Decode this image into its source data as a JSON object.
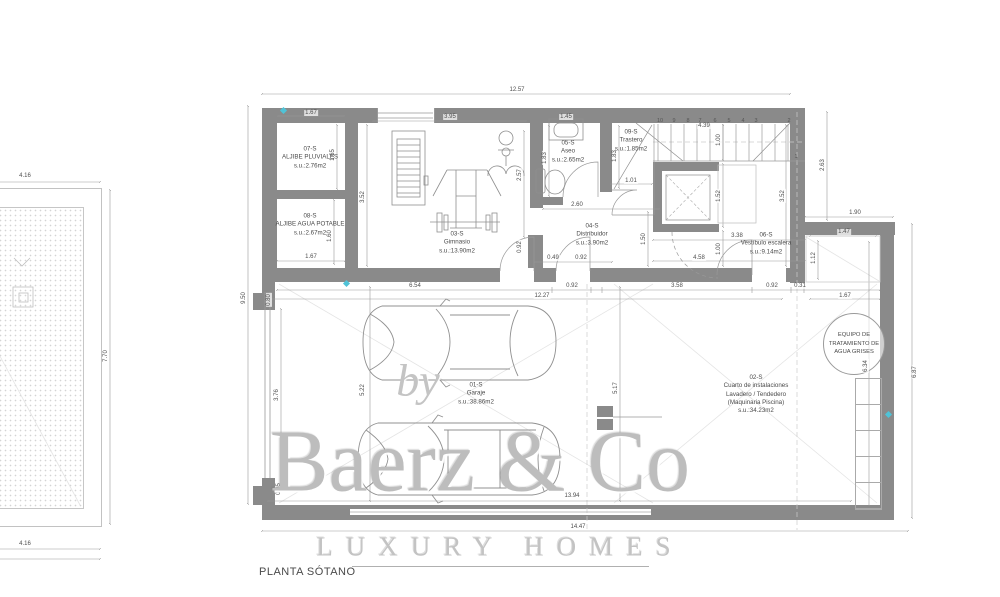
{
  "title": "PLANTA SÓTANO",
  "watermark": {
    "by": "by",
    "brand": "Baerz & Co",
    "tagline": "LUXURY HOMES"
  },
  "colors": {
    "wall": "#8a8a8a",
    "dim_line": "#9a9a9a",
    "text": "#4a4a4a",
    "marker": "#4fc3d7"
  },
  "rooms": [
    {
      "id": "07-S",
      "lines": [
        "07-S",
        "ALJIBE PLUVIALES",
        "s.u.:2.76m2"
      ],
      "cx": 310,
      "cy": 158
    },
    {
      "id": "08-S",
      "lines": [
        "08-S",
        "ALJIBE AGUA POTABLE",
        "s.u.:2.67m2"
      ],
      "cx": 310,
      "cy": 225
    },
    {
      "id": "03-S",
      "lines": [
        "03-S",
        "Gimnasio",
        "s.u.:13.90m2"
      ],
      "cx": 457,
      "cy": 243
    },
    {
      "id": "05-S",
      "lines": [
        "05-S",
        "Aseo",
        "s.u.:2.65m2"
      ],
      "cx": 568,
      "cy": 152
    },
    {
      "id": "09-S",
      "lines": [
        "09-S",
        "Trastero",
        "s.u.:1.85m2"
      ],
      "cx": 631,
      "cy": 141
    },
    {
      "id": "04-S",
      "lines": [
        "04-S",
        "Distribuidor",
        "s.u.:3.90m2"
      ],
      "cx": 592,
      "cy": 235
    },
    {
      "id": "06-S",
      "lines": [
        "06-S",
        "Vestíbulo escalera",
        "s.u.:9.14m2"
      ],
      "cx": 766,
      "cy": 244
    },
    {
      "id": "01-S",
      "lines": [
        "01-S",
        "Garaje",
        "s.u.:38.86m2"
      ],
      "cx": 476,
      "cy": 394
    },
    {
      "id": "02-S",
      "lines": [
        "02-S",
        "Cuarto de instalaciones",
        "Lavadero / Tendedero",
        "(Maquinaria Piscina)",
        "s.u.:34.23m2"
      ],
      "cx": 756,
      "cy": 395
    }
  ],
  "equipment_circle": {
    "lines": [
      "EQUIPO DE",
      "TRATAMIENTO DE",
      "AGUA GRISES"
    ]
  },
  "stairs": {
    "numbers": [
      {
        "t": "10",
        "x": 660
      },
      {
        "t": "9",
        "x": 674
      },
      {
        "t": "8",
        "x": 688
      },
      {
        "t": "7",
        "x": 700
      },
      {
        "t": "6",
        "x": 715
      },
      {
        "t": "5",
        "x": 729
      },
      {
        "t": "4",
        "x": 743
      },
      {
        "t": "3",
        "x": 756
      },
      {
        "t": "2",
        "x": 789
      }
    ],
    "numbers_y": 121,
    "last": {
      "t": "1",
      "x": 796,
      "y": 157
    }
  },
  "dimension_labels": [
    {
      "t": "12.57",
      "x": 517,
      "y": 90
    },
    {
      "t": "1.67",
      "x": 311,
      "y": 113
    },
    {
      "t": "3.95",
      "x": 450,
      "y": 117
    },
    {
      "t": "1.45",
      "x": 566,
      "y": 117
    },
    {
      "t": "4.39",
      "x": 704,
      "y": 126
    },
    {
      "t": "1.67",
      "x": 311,
      "y": 257
    },
    {
      "t": "1.01",
      "x": 631,
      "y": 181
    },
    {
      "t": "2.60",
      "x": 577,
      "y": 205
    },
    {
      "t": "3.38",
      "x": 737,
      "y": 236
    },
    {
      "t": "4.58",
      "x": 699,
      "y": 258
    },
    {
      "t": "0.49",
      "x": 553,
      "y": 258
    },
    {
      "t": "0.92",
      "x": 581,
      "y": 258
    },
    {
      "t": "1.90",
      "x": 855,
      "y": 213
    },
    {
      "t": "1.47",
      "x": 844,
      "y": 232
    },
    {
      "t": "6.54",
      "x": 415,
      "y": 286
    },
    {
      "t": "0.92",
      "x": 572,
      "y": 286
    },
    {
      "t": "3.58",
      "x": 677,
      "y": 286
    },
    {
      "t": "0.92",
      "x": 772,
      "y": 286
    },
    {
      "t": "0.31",
      "x": 800,
      "y": 286
    },
    {
      "t": "12.27",
      "x": 542,
      "y": 296
    },
    {
      "t": "1.67",
      "x": 845,
      "y": 296
    },
    {
      "t": "13.94",
      "x": 572,
      "y": 496
    },
    {
      "t": "14.47",
      "x": 578,
      "y": 527
    },
    {
      "t": "4.16",
      "x": 25,
      "y": 176
    },
    {
      "t": "4.16",
      "x": 25,
      "y": 544
    },
    {
      "t": "9.50",
      "x": 244,
      "y": 298,
      "r": 1
    },
    {
      "t": "7.70",
      "x": 106,
      "y": 356,
      "r": 1
    },
    {
      "t": "1.65",
      "x": 333,
      "y": 155,
      "r": 1
    },
    {
      "t": "1.60",
      "x": 330,
      "y": 236,
      "r": 1
    },
    {
      "t": "3.52",
      "x": 363,
      "y": 197,
      "r": 1
    },
    {
      "t": "2.57",
      "x": 520,
      "y": 175,
      "r": 1
    },
    {
      "t": "1.83",
      "x": 545,
      "y": 158,
      "r": 1
    },
    {
      "t": "1.83",
      "x": 615,
      "y": 156,
      "r": 1
    },
    {
      "t": "1.00",
      "x": 719,
      "y": 140,
      "r": 1
    },
    {
      "t": "1.52",
      "x": 719,
      "y": 196,
      "r": 1
    },
    {
      "t": "3.52",
      "x": 783,
      "y": 196,
      "r": 1
    },
    {
      "t": "1.00",
      "x": 719,
      "y": 249,
      "r": 1
    },
    {
      "t": "2.63",
      "x": 823,
      "y": 165,
      "r": 1
    },
    {
      "t": "1.12",
      "x": 814,
      "y": 258,
      "r": 1
    },
    {
      "t": "1.50",
      "x": 644,
      "y": 239,
      "r": 1
    },
    {
      "t": "0.92",
      "x": 520,
      "y": 247,
      "r": 1
    },
    {
      "t": "0.80",
      "x": 269,
      "y": 300,
      "r": 1
    },
    {
      "t": "3.76",
      "x": 277,
      "y": 395,
      "r": 1
    },
    {
      "t": "0.65",
      "x": 279,
      "y": 489,
      "r": 1
    },
    {
      "t": "5.22",
      "x": 363,
      "y": 390,
      "r": 1
    },
    {
      "t": "5.17",
      "x": 616,
      "y": 388,
      "r": 1
    },
    {
      "t": "6.34",
      "x": 866,
      "y": 366,
      "r": 1
    },
    {
      "t": "6.87",
      "x": 915,
      "y": 372,
      "r": 1
    }
  ]
}
